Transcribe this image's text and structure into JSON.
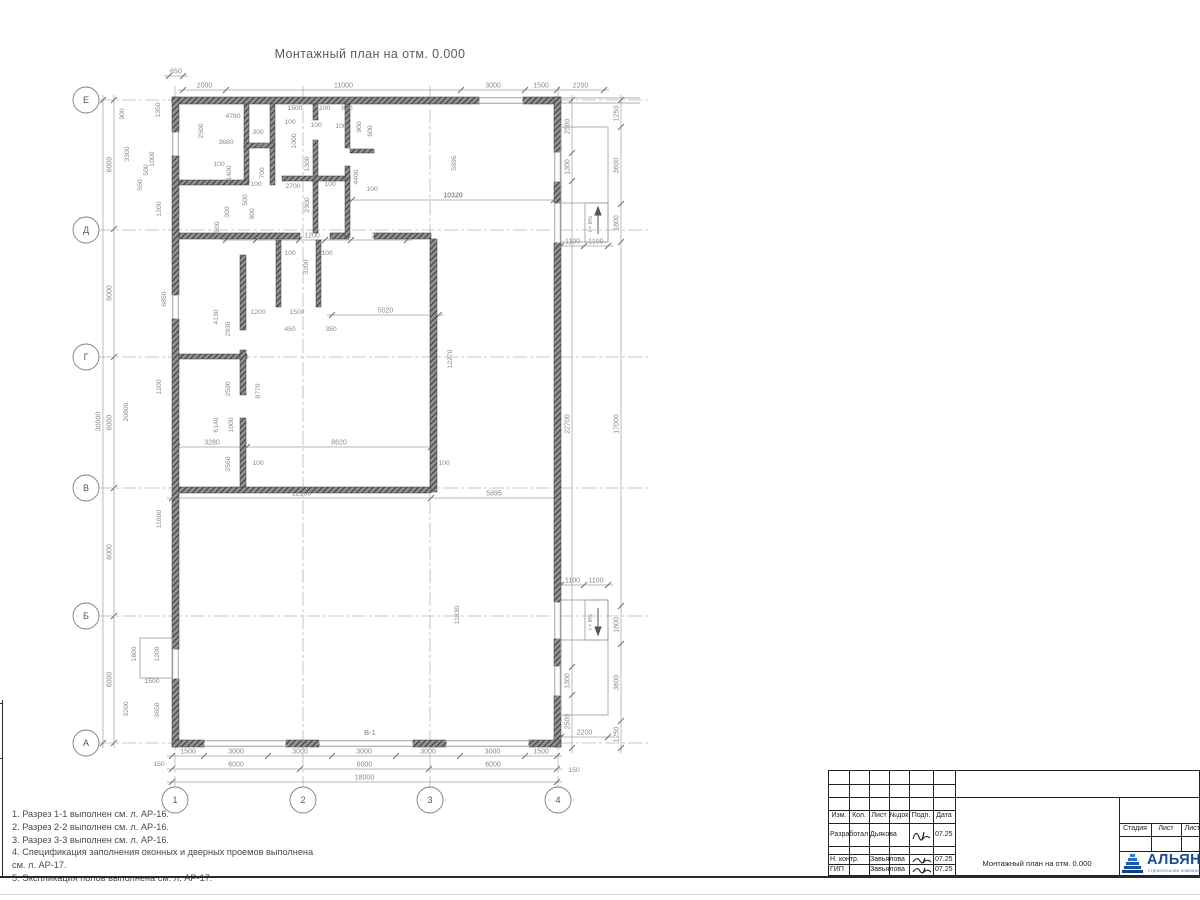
{
  "sheet": {
    "title": "Монтажный план на отм. 0.000",
    "drawing_label": "В-1",
    "slope_label": "i = 8%",
    "notes": [
      "1. Разрез 1-1 выполнен см. л. АР-16.",
      "2. Разрез 2-2 выполнен см. л. АР-16.",
      "3. Разрез 3-3 выполнен см. л. АР-16.",
      "4. Спецификация заполнения оконных и дверных проемов выполнена",
      "см. л. АР-17.",
      "5. Экспликация полов выполнена см. л. АР-17."
    ]
  },
  "axes": {
    "rows": [
      "Е",
      "Д",
      "Г",
      "В",
      "Б",
      "А"
    ],
    "cols": [
      "1",
      "2",
      "3",
      "4"
    ]
  },
  "dim_chains": {
    "top_offset": [
      "650"
    ],
    "top_main": [
      "2000",
      "11000",
      "3000",
      "1500",
      "2200"
    ],
    "bottom_detail": [
      "1500",
      "3000",
      "3000",
      "3000",
      "3000",
      "3000",
      "1500"
    ],
    "bottom_bays": [
      "6000",
      "6000",
      "6000"
    ],
    "bottom_total": [
      "18000"
    ],
    "left_total": [
      "30000"
    ],
    "left_bays": [
      "6000",
      "6000",
      "6000",
      "6000",
      "6000"
    ],
    "right_inner": [
      "2500",
      "1300",
      "22700",
      "1300",
      "2500"
    ],
    "right_outer": [
      "1250",
      "3600",
      "1800",
      "17000",
      "1800",
      "3600",
      "1250"
    ],
    "ramp_top_width": [
      "1100",
      "1100"
    ],
    "ramp_bottom_width": [
      "1100",
      "1100"
    ],
    "ramp_bottom_len": [
      "2200"
    ],
    "hall_b": [
      "12100",
      "5895"
    ],
    "hall_top": [
      "10320"
    ],
    "mid": [
      "3280",
      "8620"
    ],
    "corridor": [
      "5020"
    ],
    "d_row": [
      "1400",
      "2000",
      "1200",
      "1200",
      "2620"
    ]
  },
  "annotations": [
    {
      "t": "4780",
      "x": 233,
      "y": 118
    },
    {
      "t": "2500",
      "x": 203,
      "y": 131,
      "r": 1
    },
    {
      "t": "3680",
      "x": 226,
      "y": 144
    },
    {
      "t": "300",
      "x": 258,
      "y": 134
    },
    {
      "t": "800",
      "x": 262,
      "y": 147
    },
    {
      "t": "1500",
      "x": 295,
      "y": 110
    },
    {
      "t": "1100",
      "x": 323,
      "y": 110
    },
    {
      "t": "820",
      "x": 347,
      "y": 110
    },
    {
      "t": "100",
      "x": 290,
      "y": 124
    },
    {
      "t": "100",
      "x": 316,
      "y": 127
    },
    {
      "t": "100",
      "x": 341,
      "y": 128
    },
    {
      "t": "900",
      "x": 361,
      "y": 127,
      "r": 1
    },
    {
      "t": "600",
      "x": 372,
      "y": 131,
      "r": 1
    },
    {
      "t": "1400",
      "x": 231,
      "y": 173,
      "r": 1
    },
    {
      "t": "100",
      "x": 219,
      "y": 166
    },
    {
      "t": "700",
      "x": 264,
      "y": 173,
      "r": 1
    },
    {
      "t": "100",
      "x": 256,
      "y": 186
    },
    {
      "t": "500",
      "x": 247,
      "y": 200,
      "r": 1
    },
    {
      "t": "900",
      "x": 254,
      "y": 214,
      "r": 1
    },
    {
      "t": "300",
      "x": 229,
      "y": 212,
      "r": 1
    },
    {
      "t": "3500",
      "x": 219,
      "y": 229,
      "r": 1
    },
    {
      "t": "1300",
      "x": 309,
      "y": 164,
      "r": 1
    },
    {
      "t": "1000",
      "x": 296,
      "y": 141,
      "r": 1
    },
    {
      "t": "2700",
      "x": 293,
      "y": 188
    },
    {
      "t": "2300",
      "x": 309,
      "y": 205,
      "r": 1
    },
    {
      "t": "100",
      "x": 330,
      "y": 186
    },
    {
      "t": "4400",
      "x": 358,
      "y": 177,
      "r": 1
    },
    {
      "t": "100",
      "x": 372,
      "y": 191
    },
    {
      "t": "5895",
      "x": 456,
      "y": 163,
      "r": 1
    },
    {
      "t": "10320",
      "x": 453,
      "y": 197,
      "noline": 1
    },
    {
      "t": "3200",
      "x": 308,
      "y": 267,
      "r": 1
    },
    {
      "t": "100",
      "x": 290,
      "y": 255
    },
    {
      "t": "100",
      "x": 327,
      "y": 255
    },
    {
      "t": "1200",
      "x": 258,
      "y": 314
    },
    {
      "t": "1500",
      "x": 297,
      "y": 314
    },
    {
      "t": "450",
      "x": 290,
      "y": 331
    },
    {
      "t": "350",
      "x": 331,
      "y": 331
    },
    {
      "t": "4130",
      "x": 218,
      "y": 317,
      "r": 1
    },
    {
      "t": "2930",
      "x": 230,
      "y": 329,
      "r": 1
    },
    {
      "t": "2590",
      "x": 230,
      "y": 389,
      "r": 1
    },
    {
      "t": "8770",
      "x": 260,
      "y": 391,
      "r": 1
    },
    {
      "t": "6140",
      "x": 218,
      "y": 425,
      "r": 1
    },
    {
      "t": "1000",
      "x": 233,
      "y": 425,
      "r": 1
    },
    {
      "t": "2560",
      "x": 230,
      "y": 464,
      "r": 1
    },
    {
      "t": "100",
      "x": 258,
      "y": 465
    },
    {
      "t": "100",
      "x": 444,
      "y": 465
    },
    {
      "t": "12270",
      "x": 452,
      "y": 359,
      "r": 1
    },
    {
      "t": "11830",
      "x": 459,
      "y": 615,
      "r": 1
    },
    {
      "t": "6850",
      "x": 166,
      "y": 299,
      "r": 1
    },
    {
      "t": "20800",
      "x": 128,
      "y": 412,
      "r": 1
    },
    {
      "t": "11600",
      "x": 161,
      "y": 519,
      "r": 1
    },
    {
      "t": "900",
      "x": 124,
      "y": 114,
      "r": 1
    },
    {
      "t": "3300",
      "x": 129,
      "y": 154,
      "r": 1
    },
    {
      "t": "550",
      "x": 142,
      "y": 185,
      "r": 1
    },
    {
      "t": "500",
      "x": 148,
      "y": 170,
      "r": 1
    },
    {
      "t": "1000",
      "x": 154,
      "y": 159,
      "r": 1
    },
    {
      "t": "1350",
      "x": 160,
      "y": 110,
      "r": 1
    },
    {
      "t": "1200",
      "x": 161,
      "y": 209,
      "r": 1
    },
    {
      "t": "1200",
      "x": 161,
      "y": 387,
      "r": 1
    },
    {
      "t": "1800",
      "x": 136,
      "y": 654,
      "r": 1
    },
    {
      "t": "1200",
      "x": 159,
      "y": 654,
      "r": 1
    },
    {
      "t": "1500",
      "x": 152,
      "y": 683
    },
    {
      "t": "3200",
      "x": 128,
      "y": 709,
      "r": 1
    },
    {
      "t": "3650",
      "x": 159,
      "y": 710,
      "r": 1
    },
    {
      "t": "150",
      "x": 159,
      "y": 766
    },
    {
      "t": "150",
      "x": 574,
      "y": 772
    }
  ],
  "titleblock": {
    "header_cols": [
      "Изм.",
      "Кол.",
      "Лист",
      "№док",
      "Подп.",
      "Дата"
    ],
    "rows": [
      {
        "role": "Разработал",
        "name": "Дьякова",
        "date": "07.25"
      },
      {
        "role": "Н. контр.",
        "name": "Завьялова",
        "date": "07.25"
      },
      {
        "role": "ГИП",
        "name": "Завьялова",
        "date": "07.25"
      }
    ],
    "doc_name": "Монтажный план на отм. 0.000",
    "stage_cols": [
      "Стадия",
      "Лист",
      "Листов"
    ],
    "company": "АЛЬЯНС",
    "company_sub": "строительная компания",
    "logo_color": "#164a9b"
  }
}
